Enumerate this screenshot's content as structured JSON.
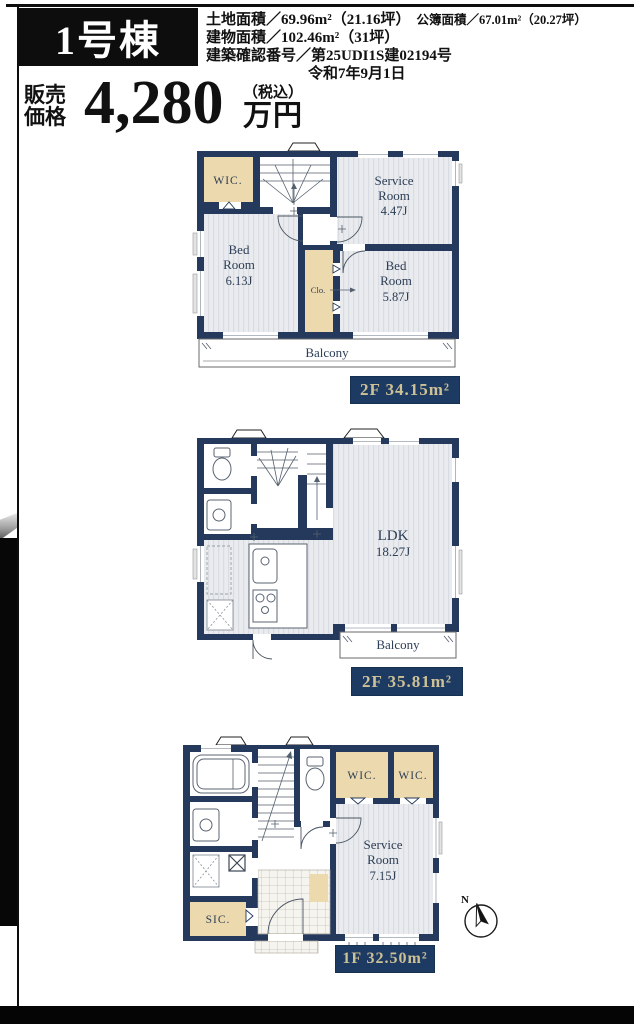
{
  "header": {
    "building_label": "1号棟",
    "land_area": "土地面積／69.96m²（21.16坪）",
    "registered_area": "公簿面積／67.01m²（20.27坪）",
    "building_area": "建物面積／102.46m²（31坪）",
    "confirmation_number": "建築確認番号／第25UDI1S建02194号",
    "confirmation_date": "令和7年9月1日"
  },
  "price": {
    "label_top": "販売",
    "label_bottom": "価格",
    "amount": "4,280",
    "tax_note": "（税込）",
    "unit": "万円"
  },
  "colors": {
    "wall_navy": "#24395b",
    "floor_light": "#e9ebee",
    "closet_beige": "#ecd9ae",
    "label_bg": "#1d3a63",
    "label_text": "#cdc196",
    "frame_black": "#0d0d0d"
  },
  "plans": {
    "upper": {
      "floor_label": "2F 34.15m²",
      "rooms": {
        "wic": "WIC.",
        "service_l1": "Service",
        "service_l2": "Room",
        "service_l3": "4.47J",
        "bed1_l1": "Bed",
        "bed1_l2": "Room",
        "bed1_l3": "6.13J",
        "clo": "Clo.",
        "bed2_l1": "Bed",
        "bed2_l2": "Room",
        "bed2_l3": "5.87J",
        "balcony": "Balcony"
      }
    },
    "middle": {
      "floor_label": "2F 35.81m²",
      "rooms": {
        "ldk_l1": "LDK",
        "ldk_l2": "18.27J",
        "balcony": "Balcony"
      }
    },
    "lower": {
      "floor_label": "1F 32.50m²",
      "rooms": {
        "wic1": "WIC.",
        "wic2": "WIC.",
        "service_l1": "Service",
        "service_l2": "Room",
        "service_l3": "7.15J",
        "sic": "SIC.",
        "compass_n": "N"
      }
    }
  }
}
